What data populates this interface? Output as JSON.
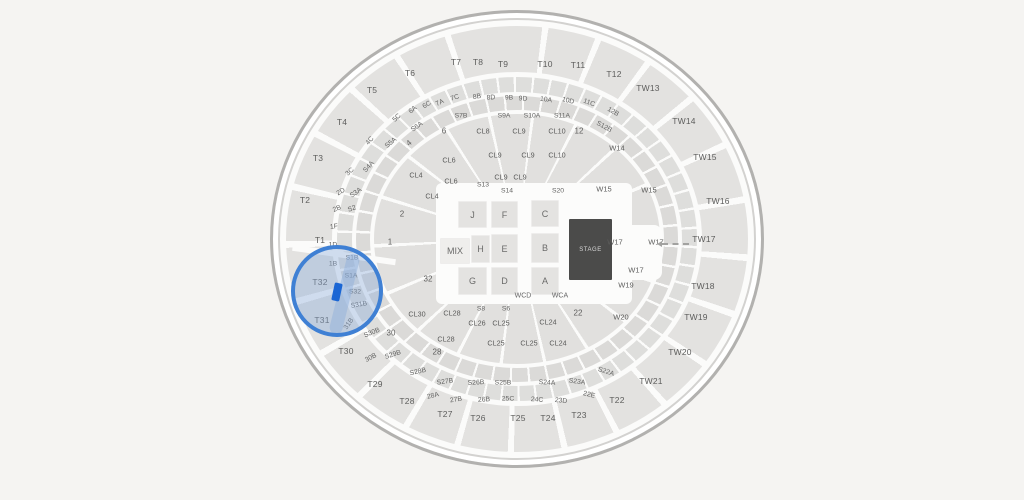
{
  "colors": {
    "background": "#f5f4f2",
    "section_fill": "#e2e1df",
    "highlight_ring": "#3f80d4",
    "highlight_fill": "rgba(137,170,217,0.38)",
    "selected_marker": "#1b66d4",
    "stage_fill": "#4b4b4a"
  },
  "floor": {
    "stage_label": "STAGE",
    "boxes": [
      {
        "t": "J",
        "x": 458,
        "y": 201,
        "w": 29,
        "h": 27
      },
      {
        "t": "F",
        "x": 491,
        "y": 201,
        "w": 27,
        "h": 27
      },
      {
        "t": "C",
        "x": 531,
        "y": 200,
        "w": 28,
        "h": 27
      },
      {
        "t": "H",
        "x": 471,
        "y": 235,
        "w": 19,
        "h": 28
      },
      {
        "t": "E",
        "x": 491,
        "y": 234,
        "w": 27,
        "h": 29
      },
      {
        "t": "B",
        "x": 531,
        "y": 233,
        "w": 28,
        "h": 30
      },
      {
        "t": "G",
        "x": 458,
        "y": 267,
        "w": 29,
        "h": 28
      },
      {
        "t": "D",
        "x": 491,
        "y": 267,
        "w": 27,
        "h": 28
      },
      {
        "t": "A",
        "x": 531,
        "y": 267,
        "w": 28,
        "h": 28
      },
      {
        "t": "MIX",
        "x": 440,
        "y": 238,
        "w": 30,
        "h": 26,
        "light": true
      }
    ]
  },
  "sections": {
    "tier": [
      {
        "t": "T1",
        "x": 320,
        "y": 240
      },
      {
        "t": "T2",
        "x": 305,
        "y": 200
      },
      {
        "t": "T3",
        "x": 318,
        "y": 158
      },
      {
        "t": "T4",
        "x": 342,
        "y": 122
      },
      {
        "t": "T5",
        "x": 372,
        "y": 90
      },
      {
        "t": "T6",
        "x": 410,
        "y": 73
      },
      {
        "t": "T7",
        "x": 456,
        "y": 62
      },
      {
        "t": "T8",
        "x": 478,
        "y": 62
      },
      {
        "t": "T9",
        "x": 503,
        "y": 64
      },
      {
        "t": "T10",
        "x": 545,
        "y": 64
      },
      {
        "t": "T11",
        "x": 578,
        "y": 65
      },
      {
        "t": "T12",
        "x": 614,
        "y": 74
      },
      {
        "t": "TW13",
        "x": 648,
        "y": 88
      },
      {
        "t": "TW14",
        "x": 684,
        "y": 121
      },
      {
        "t": "TW15",
        "x": 705,
        "y": 157
      },
      {
        "t": "TW16",
        "x": 718,
        "y": 201
      },
      {
        "t": "TW17",
        "x": 704,
        "y": 239
      },
      {
        "t": "TW18",
        "x": 703,
        "y": 286
      },
      {
        "t": "TW19",
        "x": 696,
        "y": 317
      },
      {
        "t": "TW20",
        "x": 680,
        "y": 352
      },
      {
        "t": "TW21",
        "x": 651,
        "y": 381
      },
      {
        "t": "T22",
        "x": 617,
        "y": 400
      },
      {
        "t": "T23",
        "x": 579,
        "y": 415
      },
      {
        "t": "T24",
        "x": 548,
        "y": 418
      },
      {
        "t": "T25",
        "x": 518,
        "y": 418
      },
      {
        "t": "T26",
        "x": 478,
        "y": 418
      },
      {
        "t": "T27",
        "x": 445,
        "y": 414
      },
      {
        "t": "T28",
        "x": 407,
        "y": 401
      },
      {
        "t": "T29",
        "x": 375,
        "y": 384
      },
      {
        "t": "T30",
        "x": 346,
        "y": 351
      },
      {
        "t": "T31",
        "x": 322,
        "y": 320
      },
      {
        "t": "T32",
        "x": 320,
        "y": 282
      }
    ],
    "arc": [
      {
        "t": "5C",
        "x": 397,
        "y": 118,
        "r": -45
      },
      {
        "t": "6A",
        "x": 413,
        "y": 110,
        "r": -38
      },
      {
        "t": "6C",
        "x": 427,
        "y": 105,
        "r": -32
      },
      {
        "t": "7A",
        "x": 440,
        "y": 103,
        "r": -26
      },
      {
        "t": "7C",
        "x": 455,
        "y": 98,
        "r": -18
      },
      {
        "t": "8B",
        "x": 477,
        "y": 97,
        "r": -8
      },
      {
        "t": "8D",
        "x": 491,
        "y": 98,
        "r": -4
      },
      {
        "t": "9B",
        "x": 509,
        "y": 98,
        "r": 0
      },
      {
        "t": "9D",
        "x": 523,
        "y": 99,
        "r": 4
      },
      {
        "t": "10A",
        "x": 546,
        "y": 100,
        "r": 8
      },
      {
        "t": "10D",
        "x": 568,
        "y": 101,
        "r": 14
      },
      {
        "t": "11C",
        "x": 589,
        "y": 103,
        "r": 20
      },
      {
        "t": "12B",
        "x": 613,
        "y": 112,
        "r": 30
      },
      {
        "t": "4C",
        "x": 370,
        "y": 141,
        "r": -48
      },
      {
        "t": "3C",
        "x": 350,
        "y": 172,
        "r": -42
      },
      {
        "t": "2D",
        "x": 341,
        "y": 192,
        "r": -30
      },
      {
        "t": "2B",
        "x": 337,
        "y": 209,
        "r": -22
      },
      {
        "t": "1F",
        "x": 334,
        "y": 227,
        "r": -8
      },
      {
        "t": "1D",
        "x": 333,
        "y": 245,
        "r": 0
      },
      {
        "t": "1B",
        "x": 333,
        "y": 264,
        "r": 0
      },
      {
        "t": "31B",
        "x": 349,
        "y": 324,
        "r": -55
      },
      {
        "t": "30B",
        "x": 371,
        "y": 358,
        "r": -28
      },
      {
        "t": "28A",
        "x": 433,
        "y": 396,
        "r": -14
      },
      {
        "t": "27B",
        "x": 456,
        "y": 400,
        "r": -8
      },
      {
        "t": "26B",
        "x": 484,
        "y": 400,
        "r": -3
      },
      {
        "t": "25C",
        "x": 508,
        "y": 399,
        "r": 0
      },
      {
        "t": "24C",
        "x": 537,
        "y": 400,
        "r": 3
      },
      {
        "t": "23D",
        "x": 561,
        "y": 401,
        "r": 6
      },
      {
        "t": "22E",
        "x": 589,
        "y": 395,
        "r": 14
      }
    ],
    "s": [
      {
        "t": "S5A",
        "x": 391,
        "y": 143,
        "r": -40
      },
      {
        "t": "S6A",
        "x": 417,
        "y": 127,
        "r": -35
      },
      {
        "t": "S7B",
        "x": 461,
        "y": 116,
        "r": 0
      },
      {
        "t": "S9A",
        "x": 504,
        "y": 116,
        "r": 0
      },
      {
        "t": "S10A",
        "x": 532,
        "y": 116,
        "r": 0
      },
      {
        "t": "S11A",
        "x": 562,
        "y": 116,
        "r": 0
      },
      {
        "t": "S12B",
        "x": 604,
        "y": 127,
        "r": 28
      },
      {
        "t": "S4A",
        "x": 369,
        "y": 167,
        "r": -48
      },
      {
        "t": "S3A",
        "x": 356,
        "y": 193,
        "r": -35
      },
      {
        "t": "S2",
        "x": 352,
        "y": 209,
        "r": -20
      },
      {
        "t": "S1B",
        "x": 352,
        "y": 258,
        "r": 0
      },
      {
        "t": "S1A",
        "x": 351,
        "y": 276,
        "r": 0
      },
      {
        "t": "S13",
        "x": 483,
        "y": 185,
        "r": 0
      },
      {
        "t": "S14",
        "x": 507,
        "y": 191,
        "r": 0
      },
      {
        "t": "S20",
        "x": 558,
        "y": 191,
        "r": 0
      },
      {
        "t": "S32",
        "x": 355,
        "y": 292,
        "r": 0
      },
      {
        "t": "S31B",
        "x": 359,
        "y": 305,
        "r": -10
      },
      {
        "t": "S30B",
        "x": 372,
        "y": 333,
        "r": -22
      },
      {
        "t": "S29B",
        "x": 393,
        "y": 355,
        "r": -18
      },
      {
        "t": "S28B",
        "x": 418,
        "y": 372,
        "r": -12
      },
      {
        "t": "S27B",
        "x": 445,
        "y": 382,
        "r": -8
      },
      {
        "t": "S26B",
        "x": 476,
        "y": 383,
        "r": -3
      },
      {
        "t": "S25B",
        "x": 503,
        "y": 383,
        "r": 0
      },
      {
        "t": "S24A",
        "x": 547,
        "y": 383,
        "r": 3
      },
      {
        "t": "S23A",
        "x": 577,
        "y": 382,
        "r": 8
      },
      {
        "t": "S22A",
        "x": 606,
        "y": 372,
        "r": 18
      },
      {
        "t": "S8",
        "x": 481,
        "y": 309,
        "r": 0
      },
      {
        "t": "S6",
        "x": 506,
        "y": 309,
        "r": 0
      }
    ],
    "bowl": [
      {
        "t": "2",
        "x": 402,
        "y": 214
      },
      {
        "t": "1",
        "x": 390,
        "y": 242
      },
      {
        "t": "32",
        "x": 428,
        "y": 279
      },
      {
        "t": "30",
        "x": 391,
        "y": 333
      },
      {
        "t": "28",
        "x": 437,
        "y": 352
      },
      {
        "t": "22",
        "x": 578,
        "y": 313
      },
      {
        "t": "12",
        "x": 579,
        "y": 131
      },
      {
        "t": "6",
        "x": 444,
        "y": 131
      },
      {
        "t": "4",
        "x": 409,
        "y": 143,
        "r": -40
      }
    ],
    "cl": [
      {
        "t": "CL8",
        "x": 483,
        "y": 131
      },
      {
        "t": "CL9",
        "x": 519,
        "y": 131
      },
      {
        "t": "CL10",
        "x": 557,
        "y": 131
      },
      {
        "t": "CL6",
        "x": 449,
        "y": 160
      },
      {
        "t": "CL9",
        "x": 495,
        "y": 155
      },
      {
        "t": "CL9",
        "x": 528,
        "y": 155
      },
      {
        "t": "CL10",
        "x": 557,
        "y": 155
      },
      {
        "t": "CL6",
        "x": 451,
        "y": 181
      },
      {
        "t": "CL9",
        "x": 501,
        "y": 177
      },
      {
        "t": "CL9",
        "x": 520,
        "y": 177
      },
      {
        "t": "CL4",
        "x": 416,
        "y": 175
      },
      {
        "t": "CL4",
        "x": 432,
        "y": 196
      },
      {
        "t": "CL30",
        "x": 417,
        "y": 314
      },
      {
        "t": "CL28",
        "x": 452,
        "y": 313
      },
      {
        "t": "CL26",
        "x": 477,
        "y": 323
      },
      {
        "t": "CL25",
        "x": 501,
        "y": 323
      },
      {
        "t": "CL24",
        "x": 548,
        "y": 322
      },
      {
        "t": "CL28",
        "x": 446,
        "y": 339
      },
      {
        "t": "CL25",
        "x": 496,
        "y": 343
      },
      {
        "t": "CL25",
        "x": 529,
        "y": 343
      },
      {
        "t": "CL24",
        "x": 558,
        "y": 343
      }
    ],
    "w": [
      {
        "t": "W14",
        "x": 617,
        "y": 148
      },
      {
        "t": "W15",
        "x": 604,
        "y": 189
      },
      {
        "t": "W15",
        "x": 649,
        "y": 190
      },
      {
        "t": "W17",
        "x": 615,
        "y": 242
      },
      {
        "t": "W17",
        "x": 656,
        "y": 242
      },
      {
        "t": "W17",
        "x": 636,
        "y": 270
      },
      {
        "t": "W19",
        "x": 626,
        "y": 285
      },
      {
        "t": "W20",
        "x": 621,
        "y": 317
      }
    ],
    "fsmall": [
      {
        "t": "WCD",
        "x": 523,
        "y": 296
      },
      {
        "t": "WCA",
        "x": 560,
        "y": 296
      }
    ]
  }
}
